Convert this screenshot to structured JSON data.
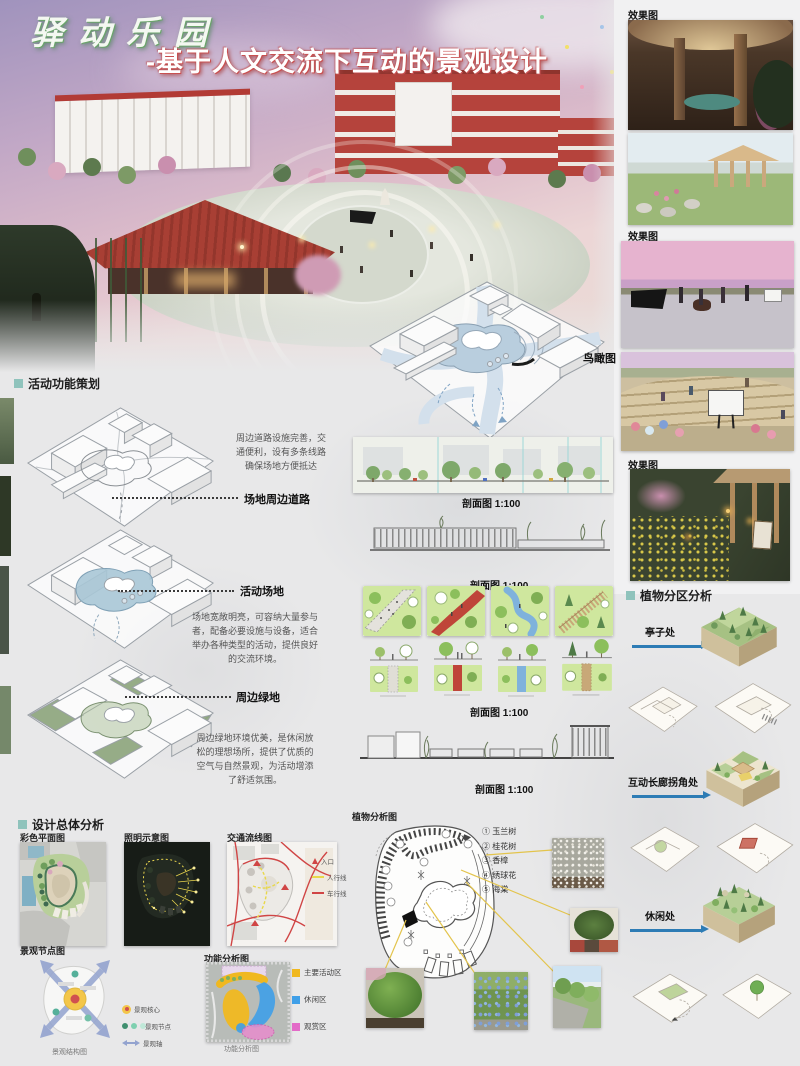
{
  "poster": {
    "title": "驿动乐园",
    "subtitle": "-基于人文交流下互动的景观设计"
  },
  "labels": {
    "effect": "效果图",
    "birdseye": "鸟瞰图",
    "section_1_100": "剖面图  1:100"
  },
  "activity": {
    "heading": "活动功能策划",
    "items": [
      {
        "label": "场地周边道路",
        "desc": "周边道路设施完善，交通便利，设有多条线路确保场地方便抵达"
      },
      {
        "label": "活动场地",
        "desc": "场地宽敞明亮，可容纳大量参与者，配备必要设施与设备，适合举办各种类型的活动，提供良好的交流环境。"
      },
      {
        "label": "周边绿地",
        "desc": "周边绿地环境优美，是休闲放松的理想场所，提供了优质的空气与自然景观，为活动增添了舒适氛围。"
      }
    ]
  },
  "plant_zone": {
    "heading": "植物分区分析",
    "zones": [
      {
        "label": "亭子处"
      },
      {
        "label": "互动长廊拐角处"
      },
      {
        "label": "休闲处"
      }
    ]
  },
  "overall": {
    "heading": "设计总体分析",
    "maps": [
      {
        "label": "彩色平面图"
      },
      {
        "label": "照明示意图"
      },
      {
        "label": "交通流线图"
      }
    ],
    "traffic_legend": [
      {
        "label": "入口"
      },
      {
        "label": "人行线"
      },
      {
        "label": "车行线"
      }
    ],
    "node_map": {
      "label": "景观节点图",
      "caption": "景观结构图",
      "legend": [
        {
          "label": "景观核心"
        },
        {
          "label": "景观节点"
        },
        {
          "label": "景观轴"
        }
      ]
    },
    "function_map": {
      "label": "功能分析图",
      "caption": "功能分析图",
      "legend": [
        {
          "label": "主要活动区",
          "color": "#f0b820"
        },
        {
          "label": "休闲区",
          "color": "#3f9fe8"
        },
        {
          "label": "观赏区",
          "color": "#e36bc8"
        }
      ]
    }
  },
  "plant_analysis": {
    "label": "植物分析图",
    "plants": [
      {
        "name": "① 玉兰树"
      },
      {
        "name": "② 桂花树"
      },
      {
        "name": "③ 香樟"
      },
      {
        "name": "④ 绣球花"
      },
      {
        "name": "⑤ 海棠"
      }
    ]
  },
  "colors": {
    "accent_teal": "#8fc3bc",
    "arrow_blue": "#2d7cb5",
    "leader_yellow": "#e3c44c",
    "title_green": "#6aa46a",
    "subtitle_red": "#c85050"
  }
}
